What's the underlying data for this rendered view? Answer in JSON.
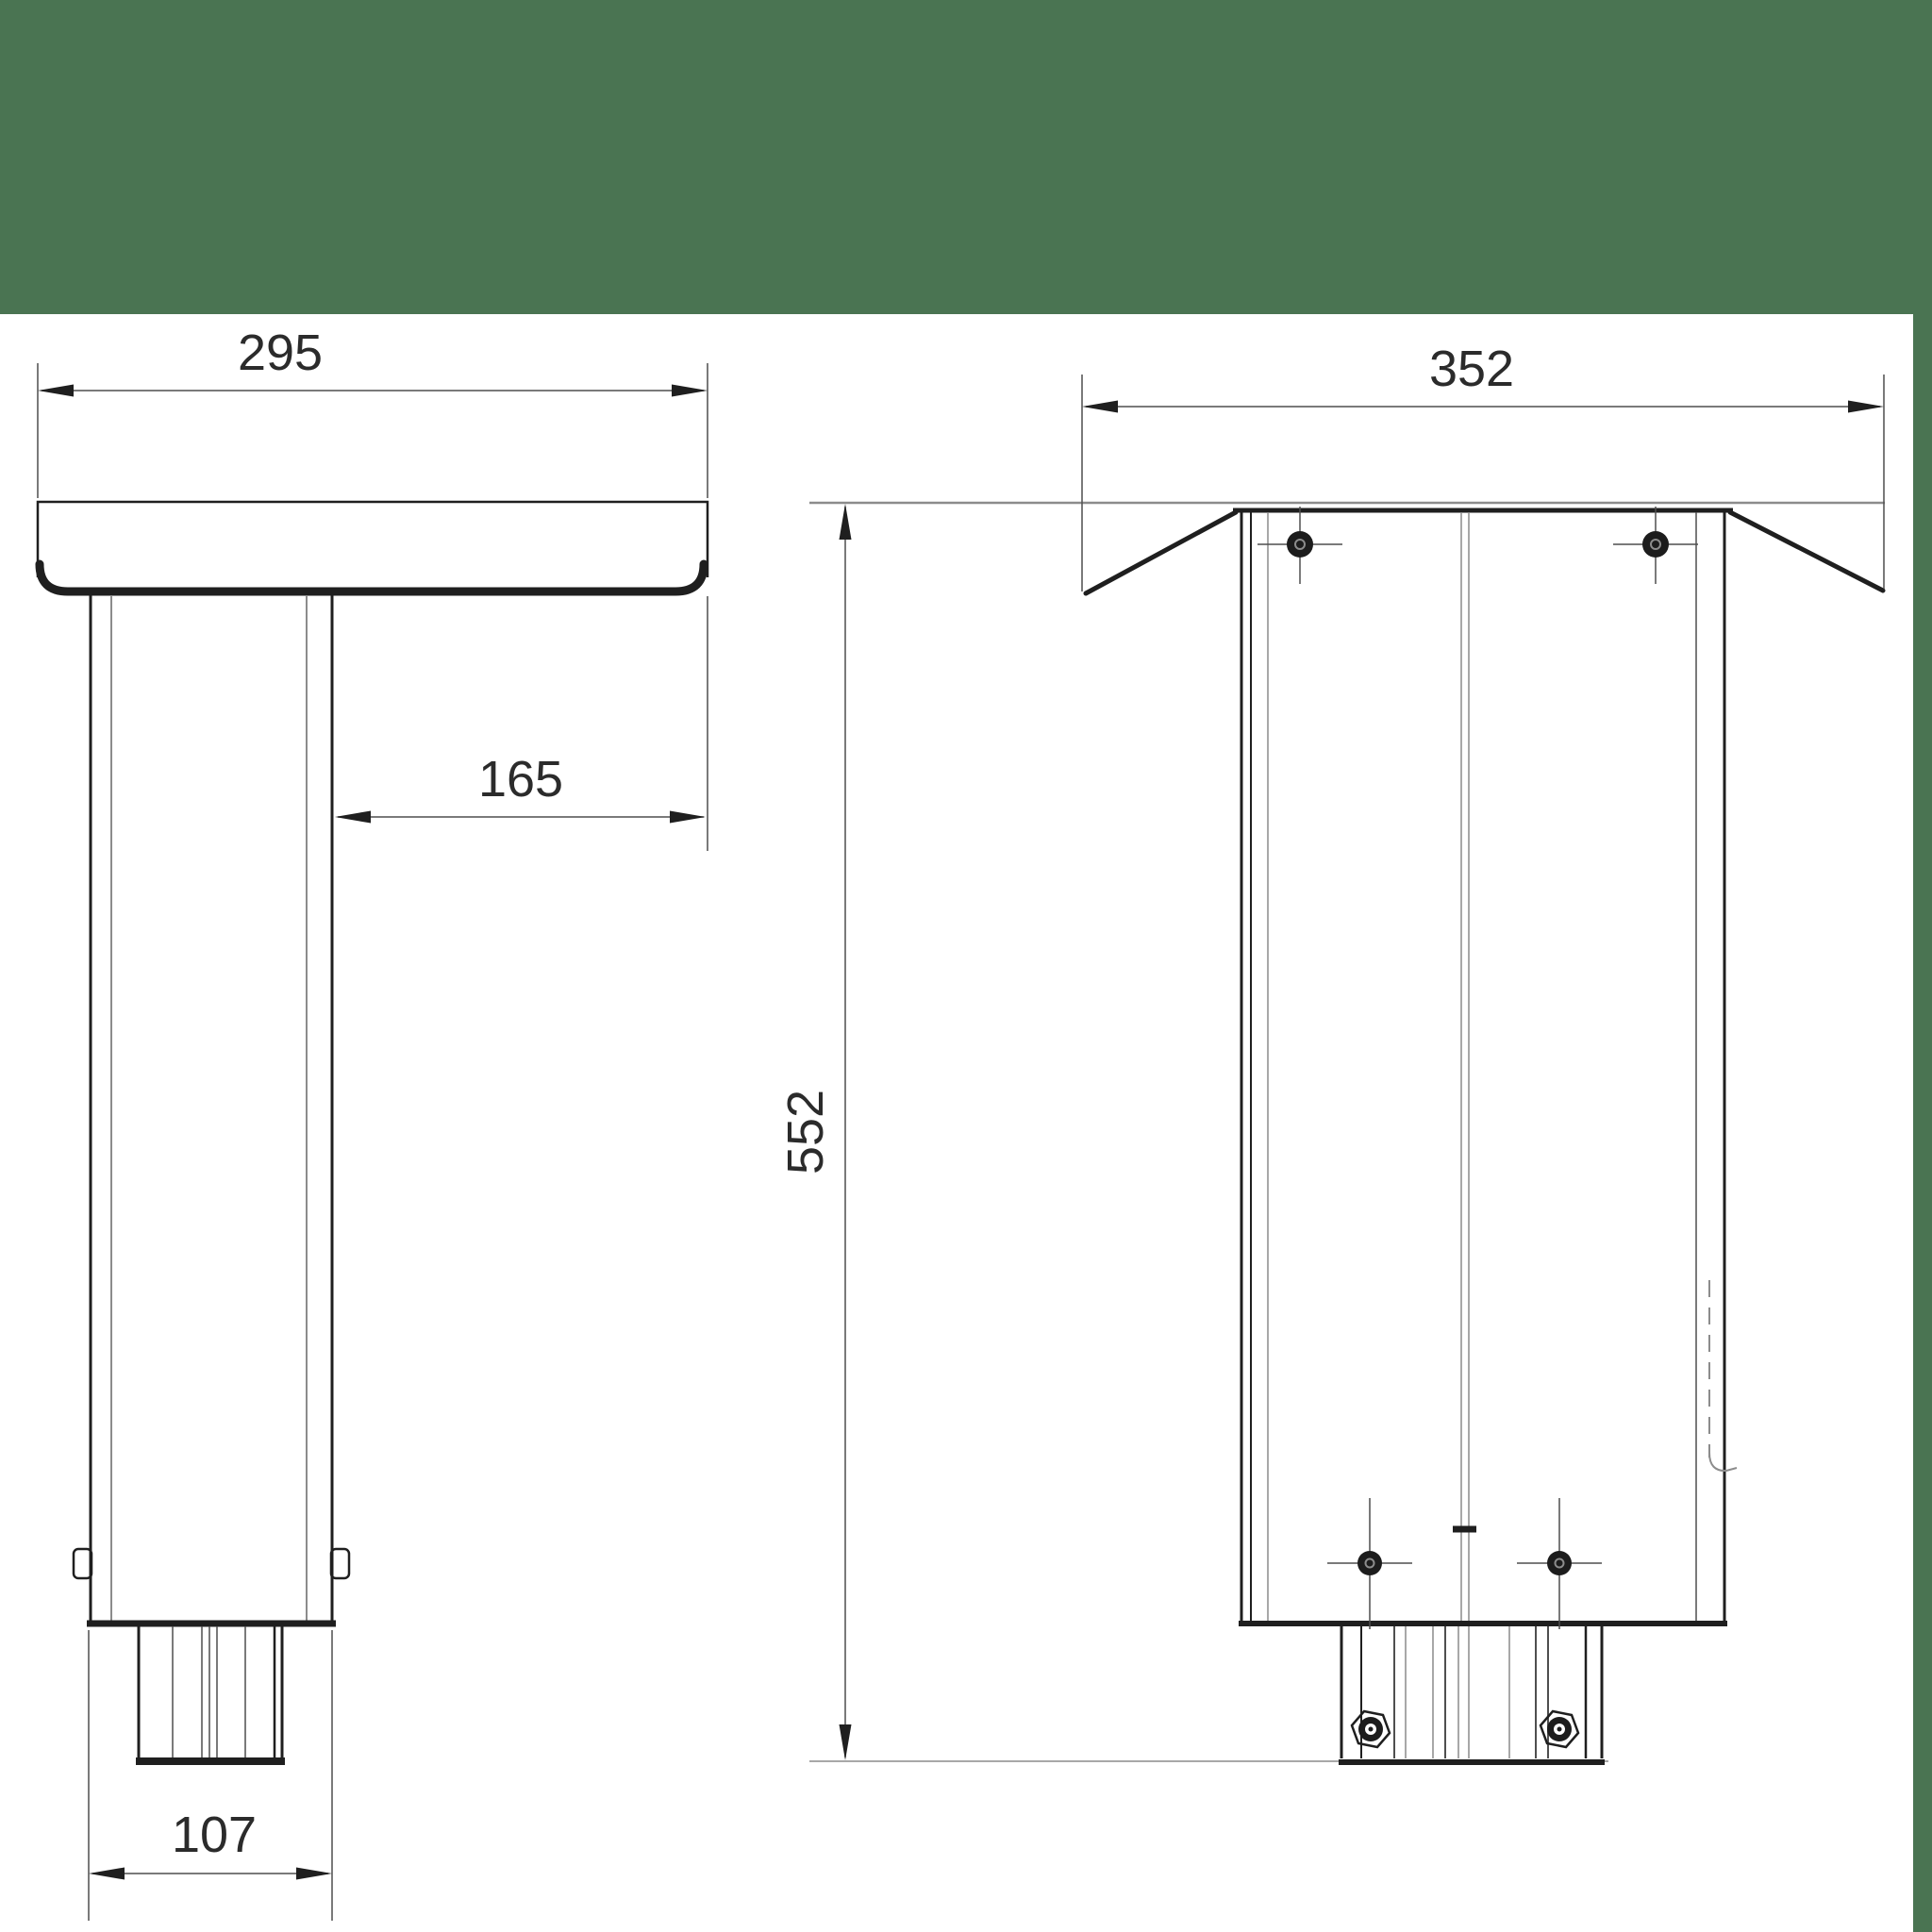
{
  "colors": {
    "band_green": "#4a7452",
    "line_dark": "#1f1f1f",
    "line_mid": "#4f4f4f",
    "line_soft": "#8c8c8c",
    "text": "#2b2b2b"
  },
  "drawing": {
    "type": "technical-dimension-drawing",
    "views": {
      "side_view": {
        "dimensions": {
          "plate_width": "295",
          "column_offset": "165",
          "foot_width": "107"
        }
      },
      "front_view": {
        "dimensions": {
          "plate_width": "352",
          "total_height": "552"
        }
      }
    }
  }
}
